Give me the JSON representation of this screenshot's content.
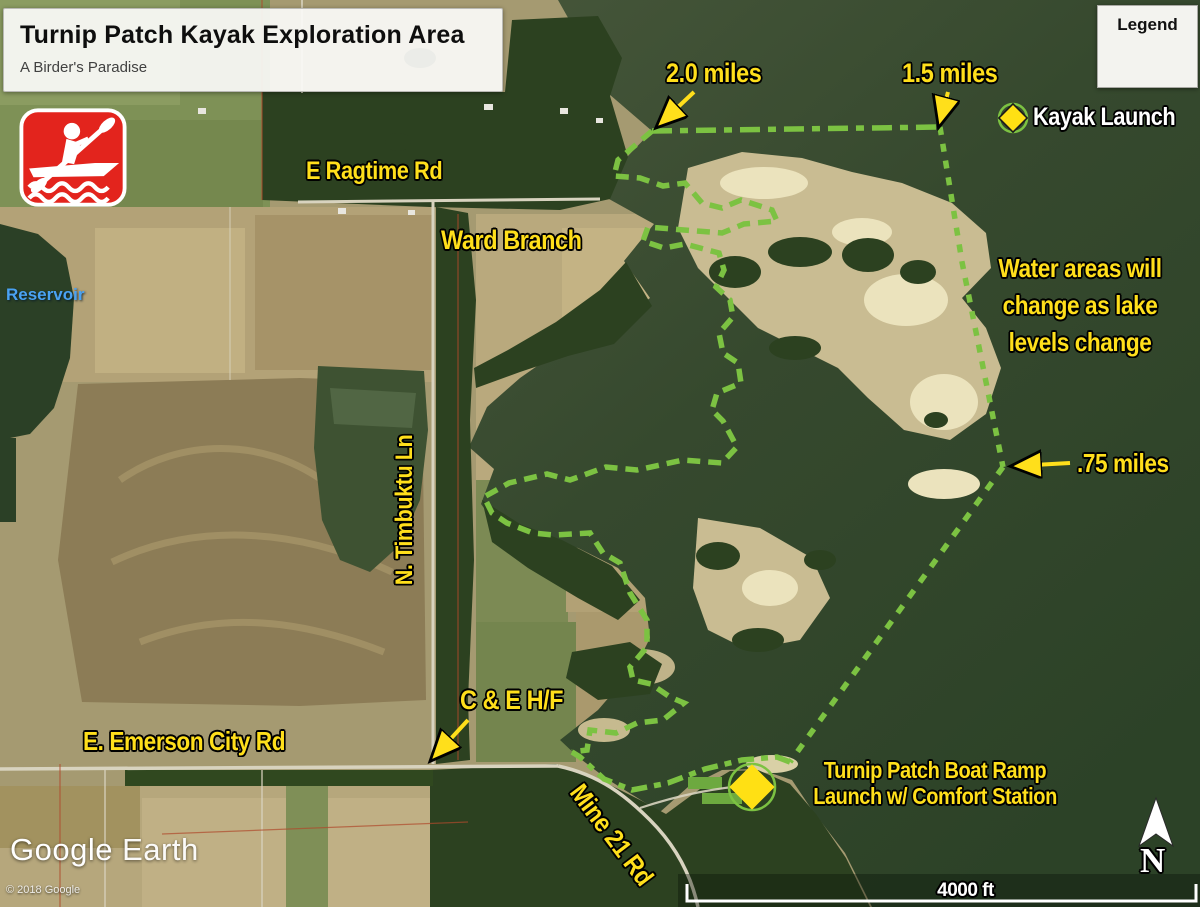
{
  "title_box": {
    "title": "Turnip Patch Kayak Exploration Area",
    "subtitle": "A Birder's Paradise"
  },
  "legend": {
    "title": "Legend",
    "item_label": "Kayak Launch"
  },
  "labels": {
    "miles_20": "2.0 miles",
    "miles_15": "1.5 miles",
    "miles_075": ".75 miles",
    "water_note_1": "Water areas will",
    "water_note_2": "change as lake",
    "water_note_3": "levels change",
    "boat_ramp_1": "Turnip Patch Boat Ramp",
    "boat_ramp_2": "Launch w/ Comfort Station",
    "ce_hf": "C & E H/F"
  },
  "roads": {
    "ragtime": "E Ragtime Rd",
    "ward_branch": "Ward Branch",
    "timbuktu": "N. Timbuktu Ln",
    "emerson": "E. Emerson City Rd",
    "mine21": "Mine 21 Rd"
  },
  "water_labels": {
    "reservoir": "Reservoir"
  },
  "attribution": {
    "brand_google": "Google",
    "brand_earth": "Earth",
    "copyright": "© 2018 Google"
  },
  "scale": {
    "distance": "4000 ft"
  },
  "compass": {
    "letter": "N"
  },
  "colors": {
    "label_yellow": "#FFDF1B",
    "boundary_green": "#7CC242",
    "kayak_icon_red": "#E3241D",
    "reservoir_label_blue": "#4AA2F2",
    "water_dark": "#2E4428"
  },
  "boundary": {
    "top": "652,131 940,127",
    "right": "940,127 962,262 1003,467",
    "diagonal": "1003,467 790,762",
    "bottom": "790,762 777,757 742,760 705,769 668,783 632,790 604,779 580,757 572,752",
    "left": "652,131 618,160 614,176 640,178 663,186 685,183 702,203 722,208 741,200 772,210 777,221 744,224 722,233 684,230 648,227 643,241 664,248 685,244 719,253 724,270 716,287 730,300 733,317 719,333 723,353 738,363 741,383 717,393 712,410 723,421 737,447 722,463 683,460 637,470 606,467 570,480 547,474 509,483 484,497 492,513 507,523 533,533 554,535 590,533 603,553 620,563 630,593 647,620 647,647 630,667 633,680 651,684 670,697 684,703 663,720 637,723 616,733 590,730 587,750 572,752"
  }
}
